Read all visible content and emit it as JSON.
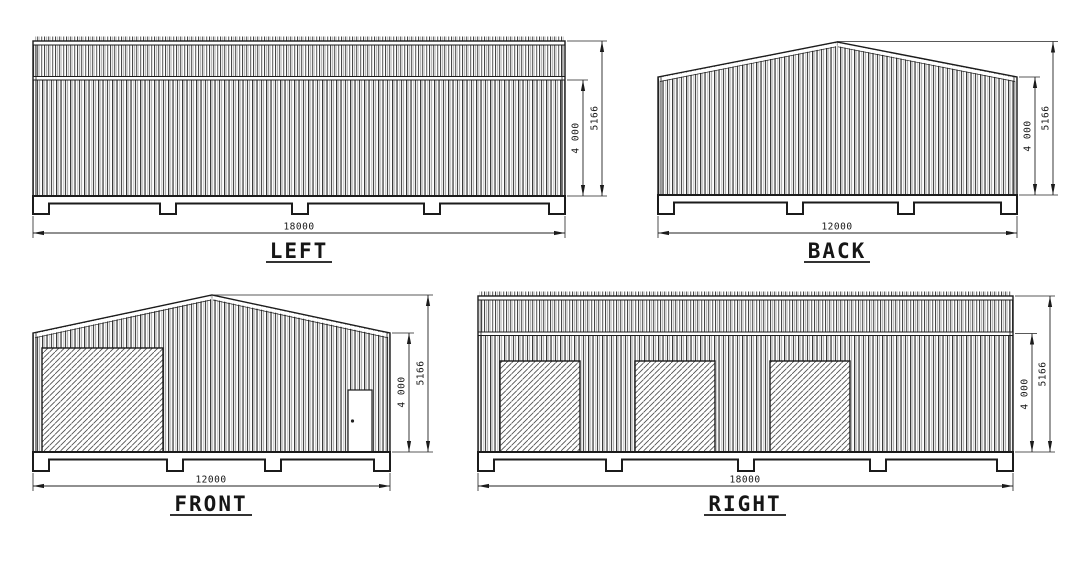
{
  "drawing": {
    "type": "building-elevations",
    "views": {
      "left": {
        "label": "LEFT",
        "width_dim": "18000",
        "eave_height_dim": "4 000",
        "ridge_height_dim": "5166"
      },
      "back": {
        "label": "BACK",
        "width_dim": "12000",
        "eave_height_dim": "4 000",
        "ridge_height_dim": "5166"
      },
      "front": {
        "label": "FRONT",
        "width_dim": "12000",
        "eave_height_dim": "4 000",
        "ridge_height_dim": "5166"
      },
      "right": {
        "label": "RIGHT",
        "width_dim": "18000",
        "eave_height_dim": "4 000",
        "ridge_height_dim": "5166"
      }
    },
    "colors": {
      "background": "#ffffff",
      "line": "#1b1b1b",
      "dimension": "#222222",
      "hatch": "#4f4f4f"
    }
  }
}
